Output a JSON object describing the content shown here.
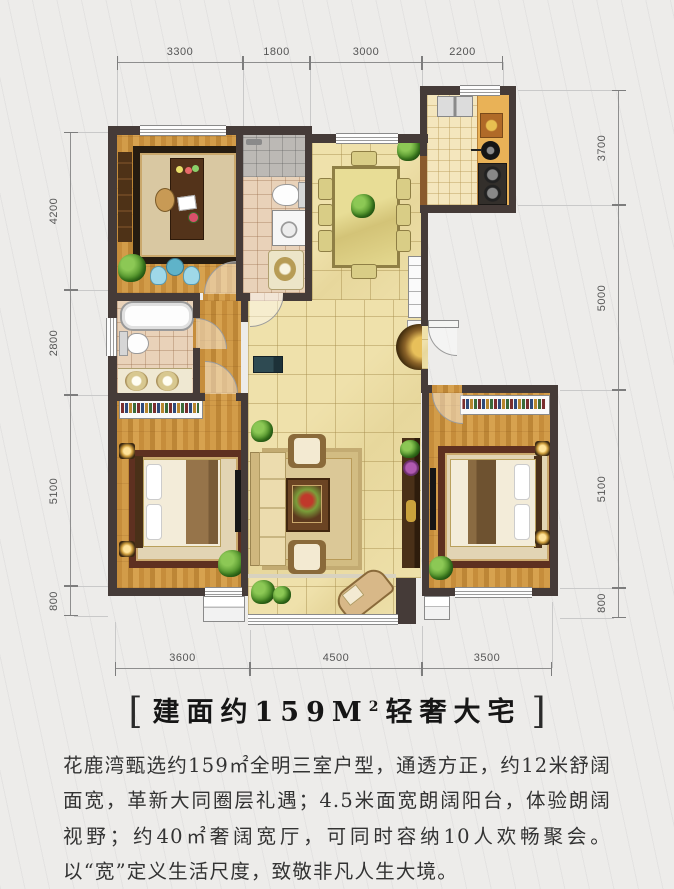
{
  "title": {
    "open_bracket": "[",
    "prefix": "建面约159M",
    "superscript": "2",
    "suffix": "轻奢大宅",
    "close_bracket": "]"
  },
  "description": "花鹿湾甄选约159㎡全明三室户型，通透方正，约12米舒阔面宽，革新大同圈层礼遇；4.5米面宽朗阔阳台，体验朗阔视野；约40㎡奢阔宽厅，可同时容纳10人欢畅聚会。以“宽”定义生活尺度，致敬非凡人生大境。",
  "dimensions": {
    "top": [
      "3300",
      "1800",
      "3000",
      "2200"
    ],
    "bottom": [
      "3600",
      "4500",
      "3500"
    ],
    "left": [
      "4200",
      "2800",
      "5100",
      "800"
    ],
    "right": [
      "3700",
      "5000",
      "5100",
      "800"
    ]
  },
  "colors": {
    "wall": "#453b38",
    "wood_floor": "#cc9442",
    "tile_floor": "#ecdca4",
    "kitchen_counter": "#e9b257",
    "background": "#edecea"
  }
}
